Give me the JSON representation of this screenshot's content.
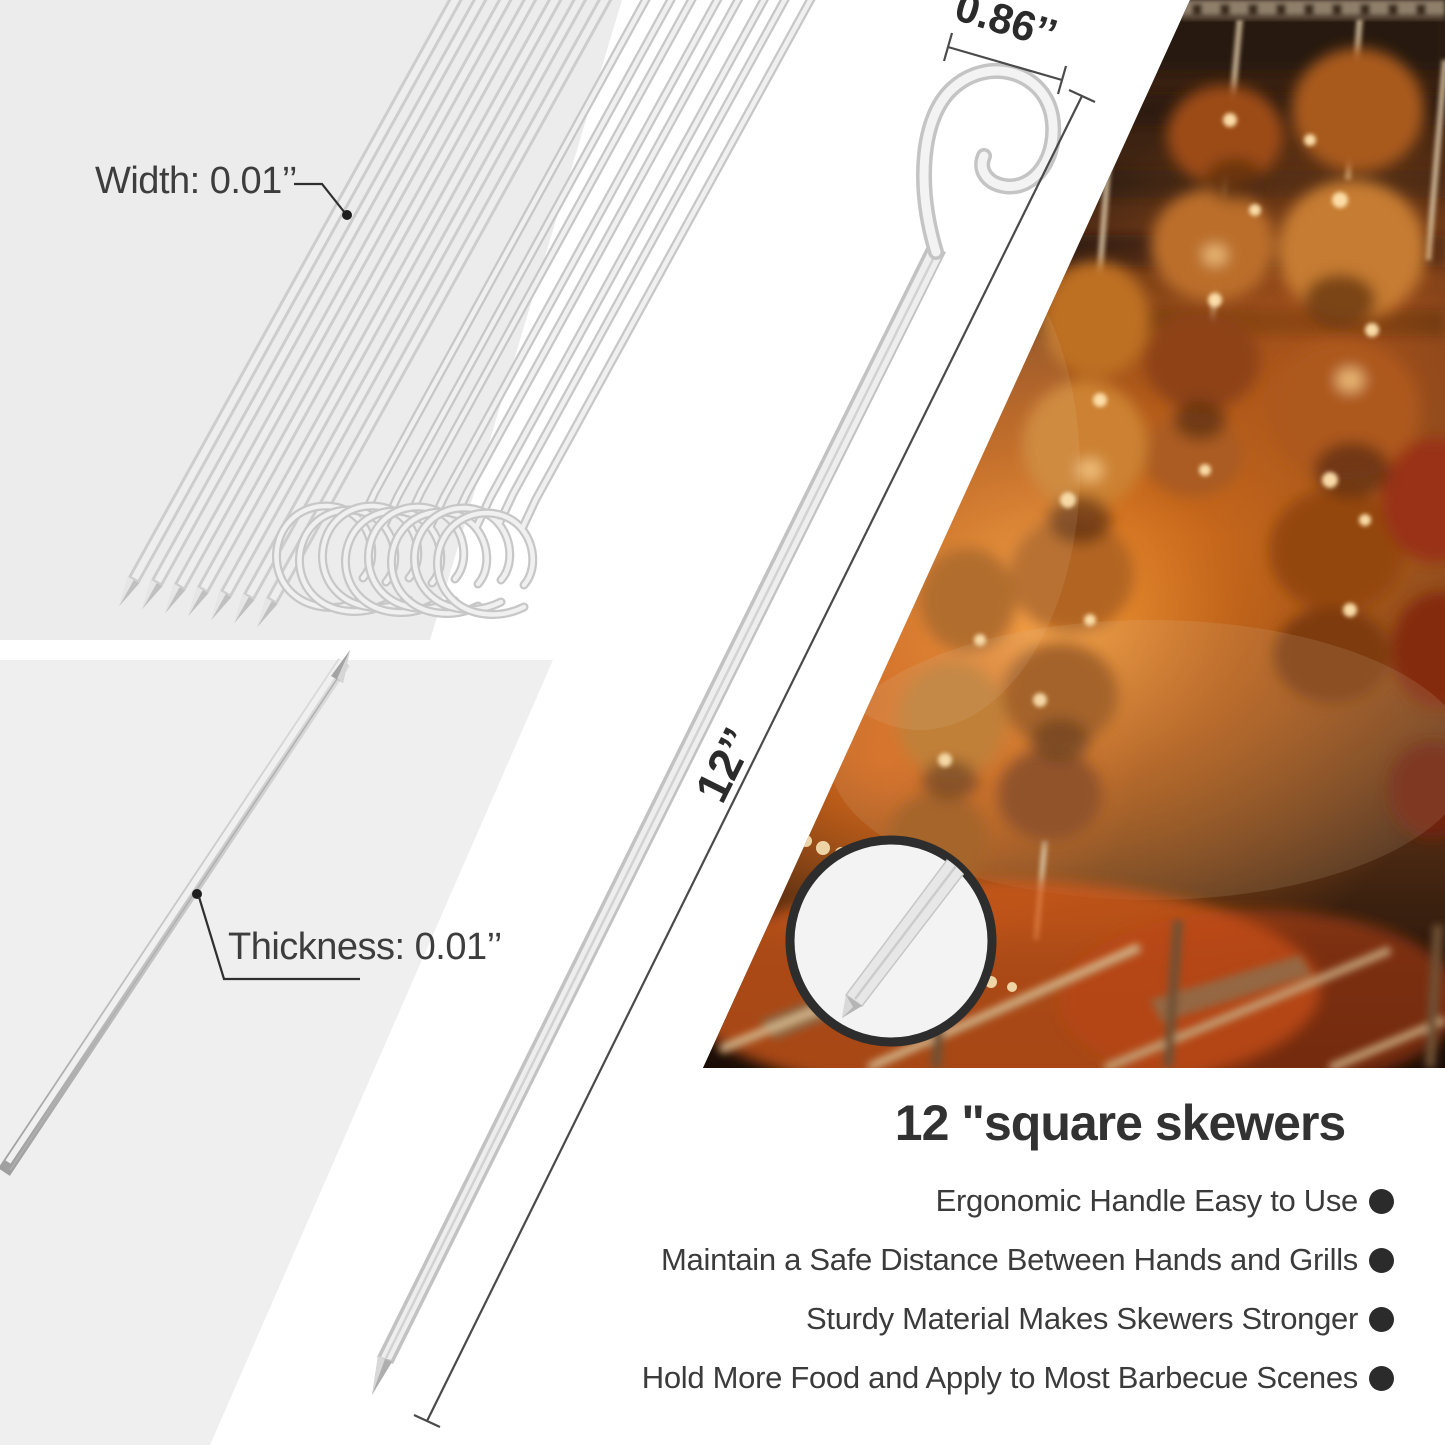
{
  "colors": {
    "panel_gray_top": "#ececec",
    "panel_gray_bottom": "#efefef",
    "steel_light": "#f2f2f2",
    "steel_edge": "#c4c4c4",
    "dim_line": "#4a4a4a",
    "text_dark": "#3d3d3d",
    "heading_dark": "#323232",
    "inset_ring": "#2d2d2d",
    "photo_glow": "#e07818"
  },
  "diagram": {
    "width_label": "Width: 0.01’’",
    "thickness_label": "Thickness: 0.01’’",
    "handle_width": "0.86’’",
    "skewer_length": "12’’"
  },
  "info": {
    "title": "12 \"square skewers",
    "bullets": [
      "Ergonomic Handle Easy to Use",
      "Maintain a Safe Distance Between Hands and Grills",
      "Sturdy Material Makes Skewers Stronger",
      "Hold More Food and Apply to Most Barbecue Scenes"
    ]
  }
}
